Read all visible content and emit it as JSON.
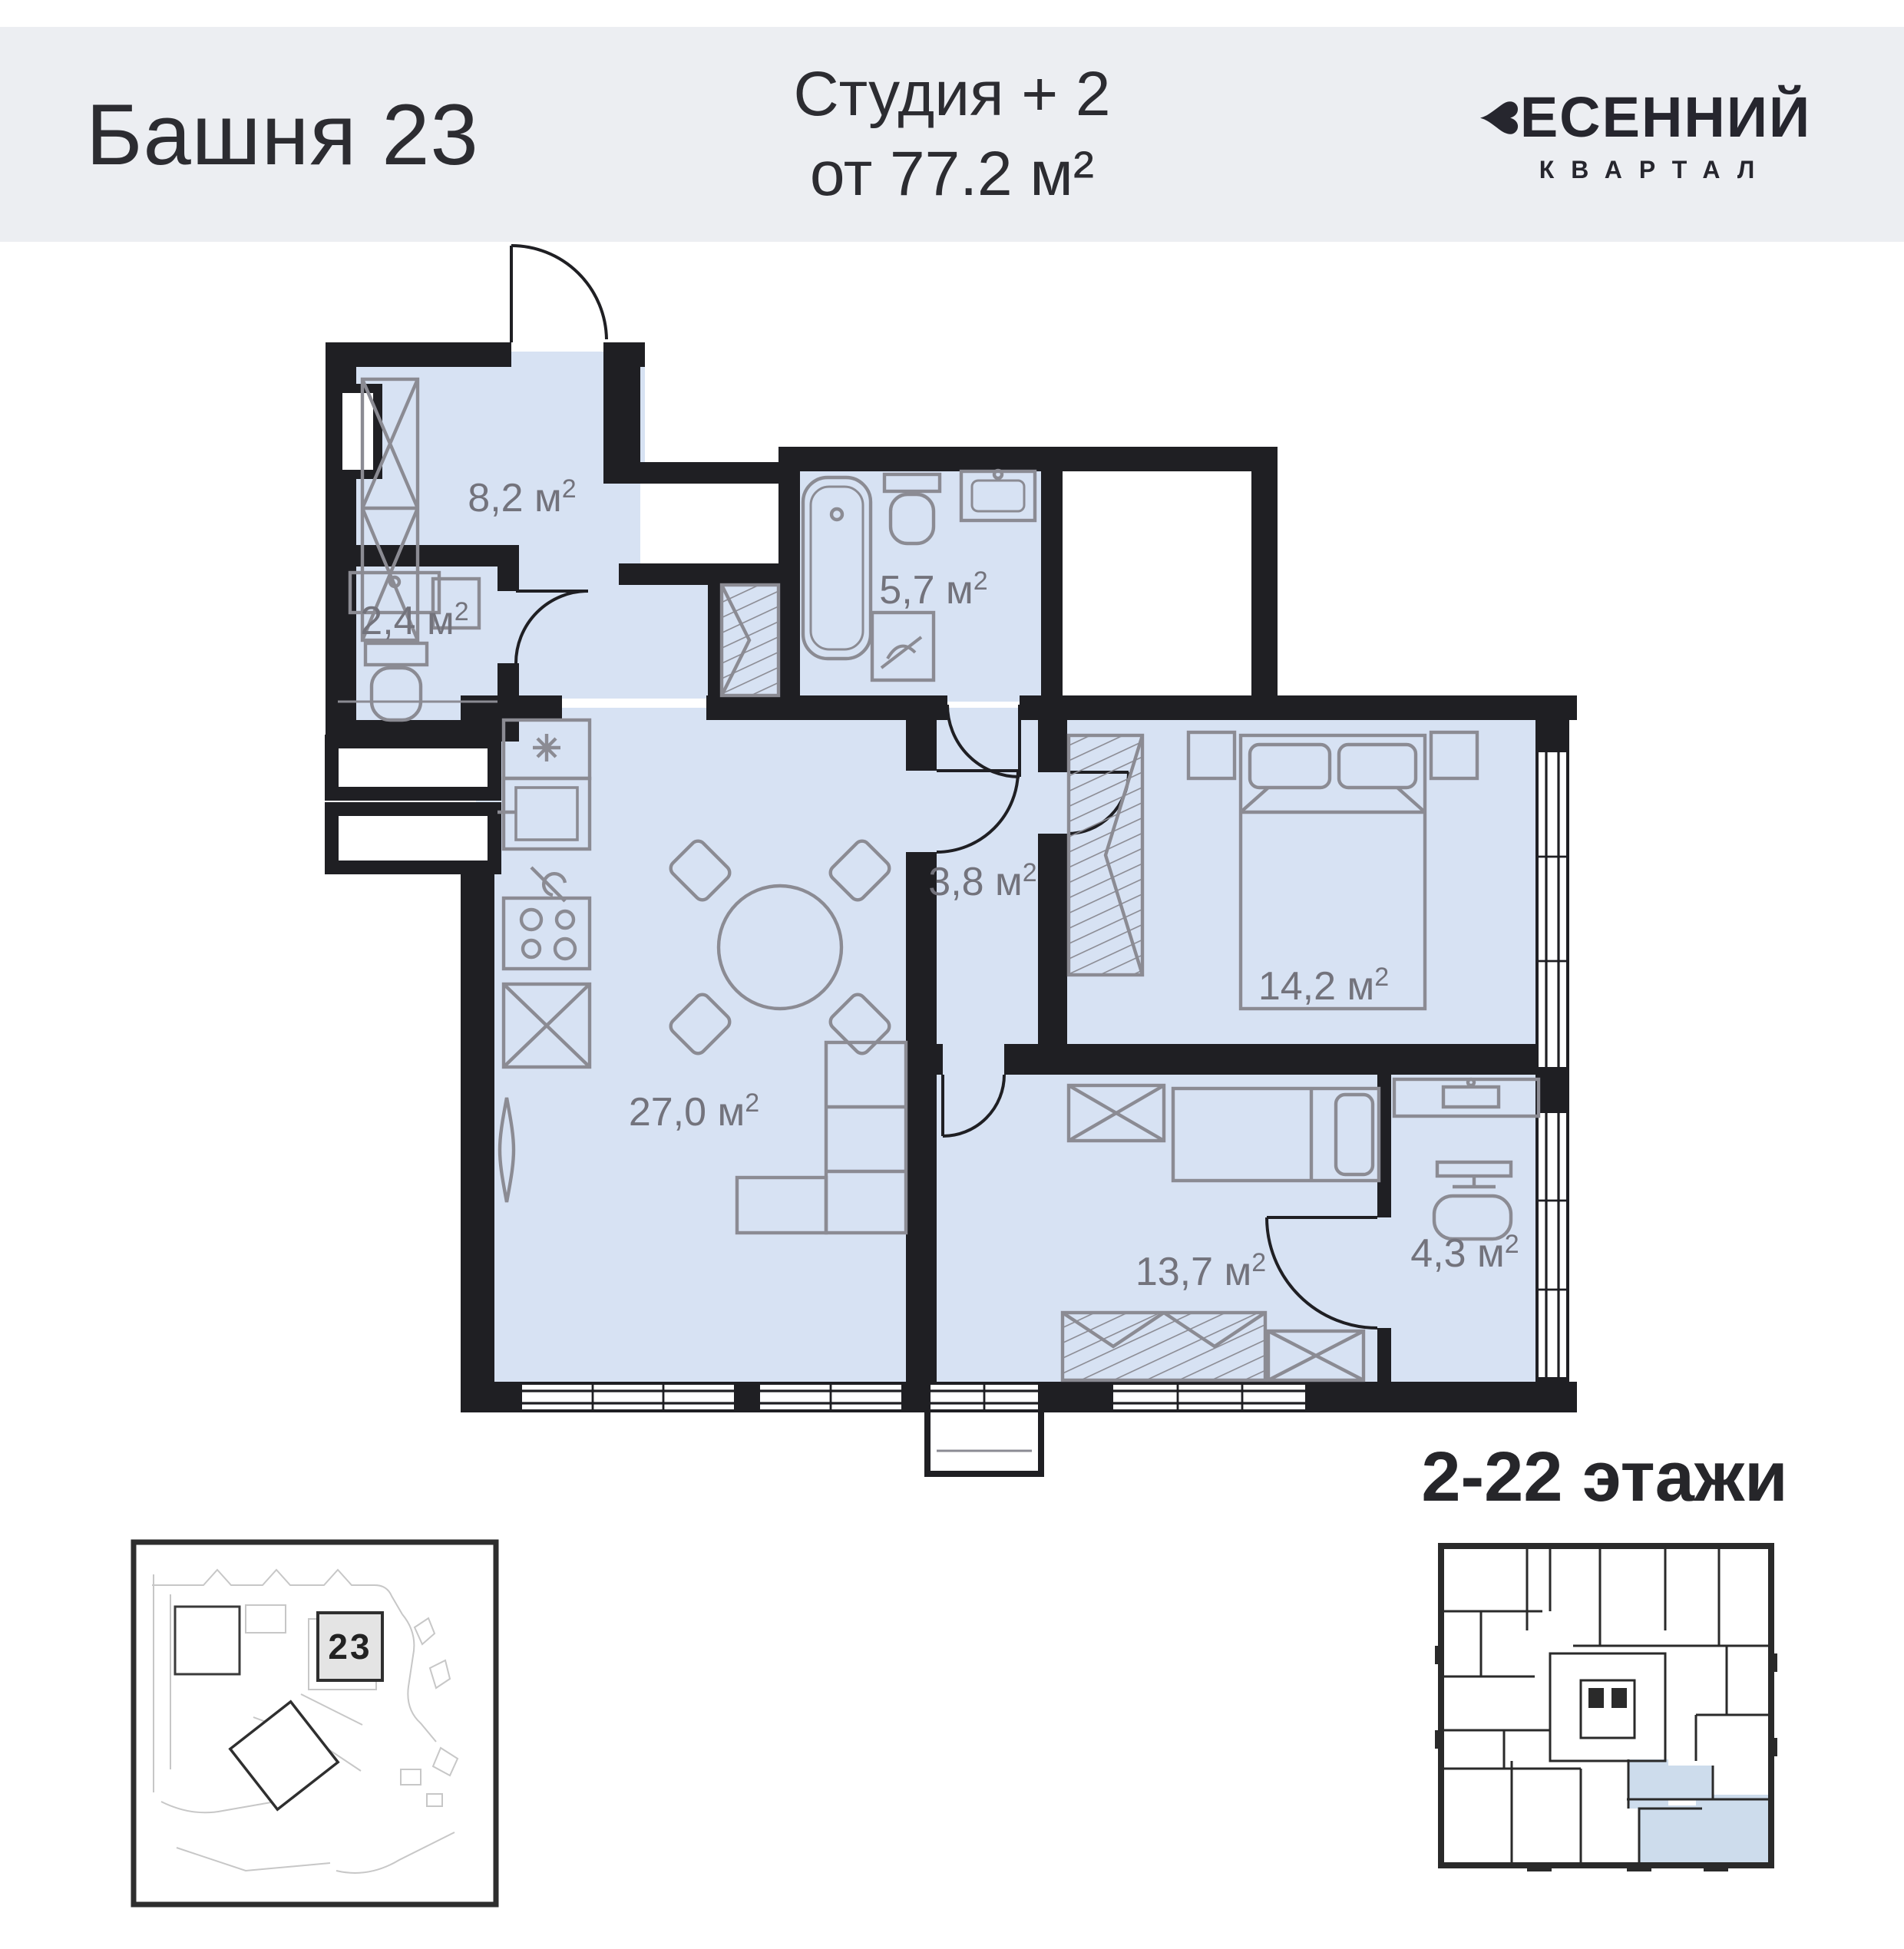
{
  "header": {
    "tower": "Башня 23",
    "type_line": "Студия + 2",
    "area_line": "от 77.2 м²",
    "brand_heart": "♥",
    "brand_top": "ЕСЕННИЙ",
    "brand_bottom": "КВАРТАЛ"
  },
  "plan": {
    "sup": "2",
    "rooms": [
      {
        "name": "hallway",
        "area": "8,2 м"
      },
      {
        "name": "wc",
        "area": "2,4 м"
      },
      {
        "name": "bathroom",
        "area": "5,7 м"
      },
      {
        "name": "inner-hall",
        "area": "3,8 м"
      },
      {
        "name": "bedroom",
        "area": "14,2 м"
      },
      {
        "name": "living-kitchen",
        "area": "27,0 м"
      },
      {
        "name": "bedroom-2",
        "area": "13,7 м"
      },
      {
        "name": "workspace",
        "area": "4,3 м"
      }
    ]
  },
  "site_map": {
    "building_number": "23"
  },
  "floors": {
    "label": "2-22 этажи"
  },
  "colors": {
    "header_bg": "#eceef2",
    "wall": "#1f1f23",
    "room_fill": "#d7e2f3",
    "furniture": "#8b8b93",
    "label": "#73737c",
    "keyplan_highlight": "#cddcec"
  }
}
